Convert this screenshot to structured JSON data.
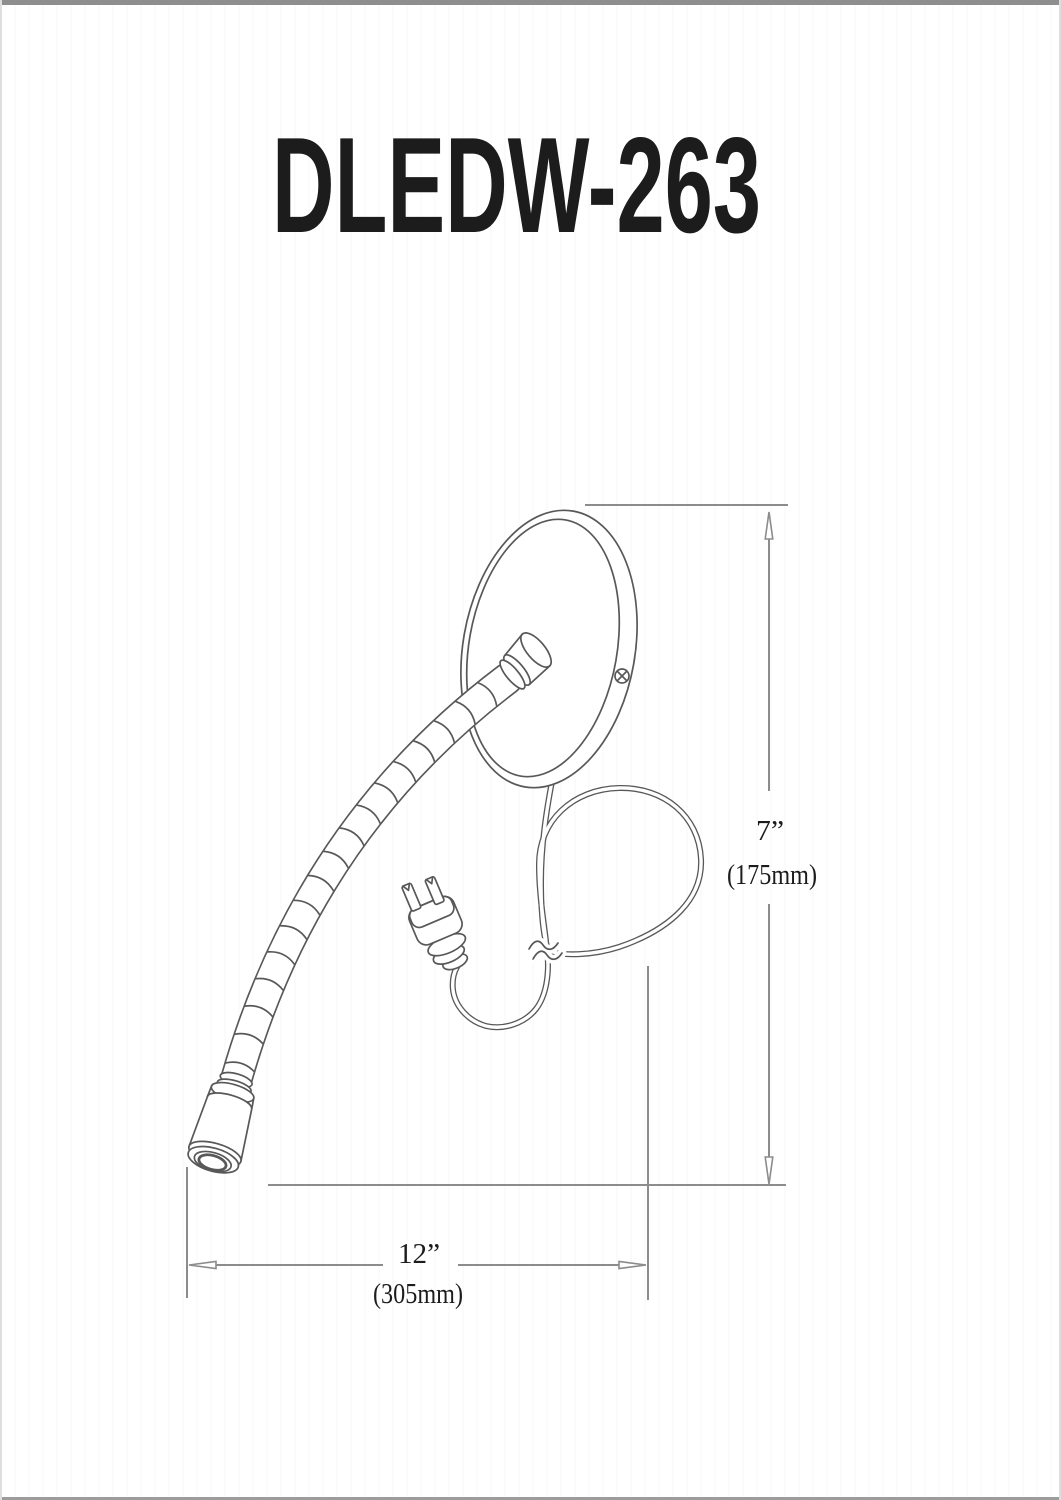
{
  "page": {
    "title": "DLEDW-263"
  },
  "dims": {
    "height": {
      "imperial": "7”",
      "metric": "(175mm)"
    },
    "width": {
      "imperial": "12”",
      "metric": "(305mm)"
    }
  },
  "colors": {
    "line": "#585858",
    "dimension": "#8c8c8c",
    "text": "#1c1c1c"
  },
  "drawing": {
    "subject": "LED gooseneck wall reading lamp line drawing",
    "parts": [
      "round-canopy",
      "mounting-screw",
      "socket-stub",
      "gooseneck-arm",
      "cylindrical-lamp-head",
      "power-cord-loop",
      "cord-break-symbol",
      "two-prong-plug"
    ]
  }
}
